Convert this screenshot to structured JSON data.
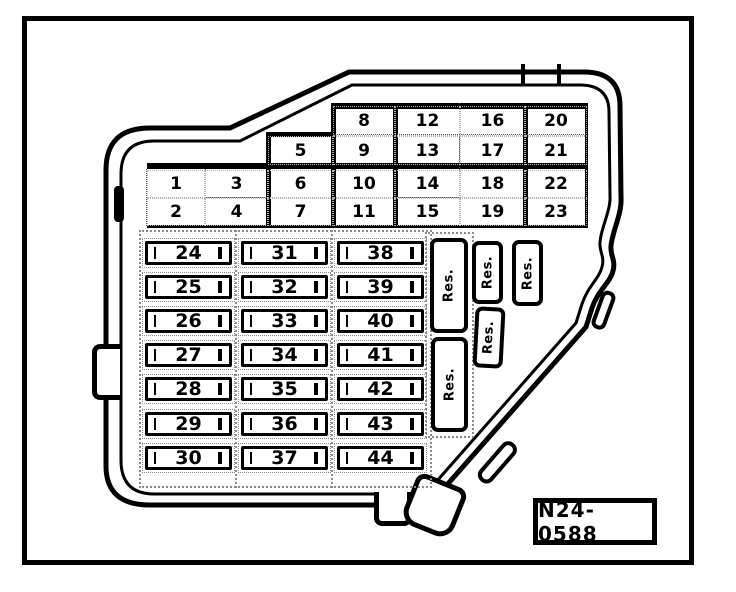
{
  "part_label": "N24-0588",
  "small_fuse_grid": {
    "columns": [
      [
        "1",
        "2"
      ],
      [
        "3",
        "4"
      ],
      [
        "5",
        "6",
        "7"
      ],
      [
        "8",
        "9",
        "10",
        "11"
      ],
      [
        "12",
        "13",
        "14",
        "15"
      ],
      [
        "16",
        "17",
        "18",
        "19"
      ],
      [
        "20",
        "21",
        "22",
        "23"
      ]
    ]
  },
  "large_fuse_columns": [
    [
      "24",
      "25",
      "26",
      "27",
      "28",
      "29",
      "30"
    ],
    [
      "31",
      "32",
      "33",
      "34",
      "35",
      "36",
      "37"
    ],
    [
      "38",
      "39",
      "40",
      "41",
      "42",
      "43",
      "44"
    ]
  ],
  "reserve_slots": [
    "Res.",
    "Res.",
    "Res.",
    "Res.",
    "Res."
  ],
  "colors": {
    "ink": "#000000",
    "paper": "#ffffff"
  }
}
